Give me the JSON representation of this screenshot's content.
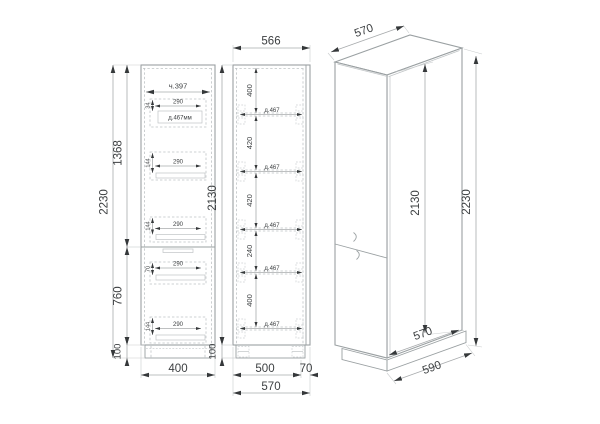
{
  "colors": {
    "background": "#ffffff",
    "outline": "#9aa0a2",
    "dashed": "#bfc3c5",
    "dimension_line": "#a8abad",
    "arrow": "#35383a",
    "text": "#3d4042"
  },
  "left_view": {
    "top_inner_width": "ч.397",
    "total_height": "2230",
    "upper_height": "1368",
    "lower_height": "760",
    "plinth_height": "100",
    "base_width": "400",
    "drawers": [
      {
        "width": "290",
        "height": "34",
        "depth": "д.467мм"
      },
      {
        "width": "290",
        "height": "144"
      },
      {
        "width": "290",
        "height": "144"
      },
      {
        "width": "290",
        "height": "70"
      },
      {
        "width": "290",
        "height": "144"
      }
    ]
  },
  "front_view": {
    "top_width": "566",
    "body_height": "2130",
    "plinth_height": "100",
    "sections": [
      {
        "height": "400",
        "shelf_depth": "д.467"
      },
      {
        "height": "420",
        "shelf_depth": "д.467"
      },
      {
        "height": "420",
        "shelf_depth": "д.467"
      },
      {
        "height": "240",
        "shelf_depth": "д.467"
      },
      {
        "height": "400",
        "shelf_depth": "д.467"
      }
    ],
    "bottom_body_width": "500",
    "bottom_side_width": "70",
    "bottom_total_width": "570"
  },
  "iso_view": {
    "top_depth": "570",
    "body_height": "2130",
    "total_height": "2230",
    "bottom_depth": "570",
    "base_depth": "590"
  }
}
